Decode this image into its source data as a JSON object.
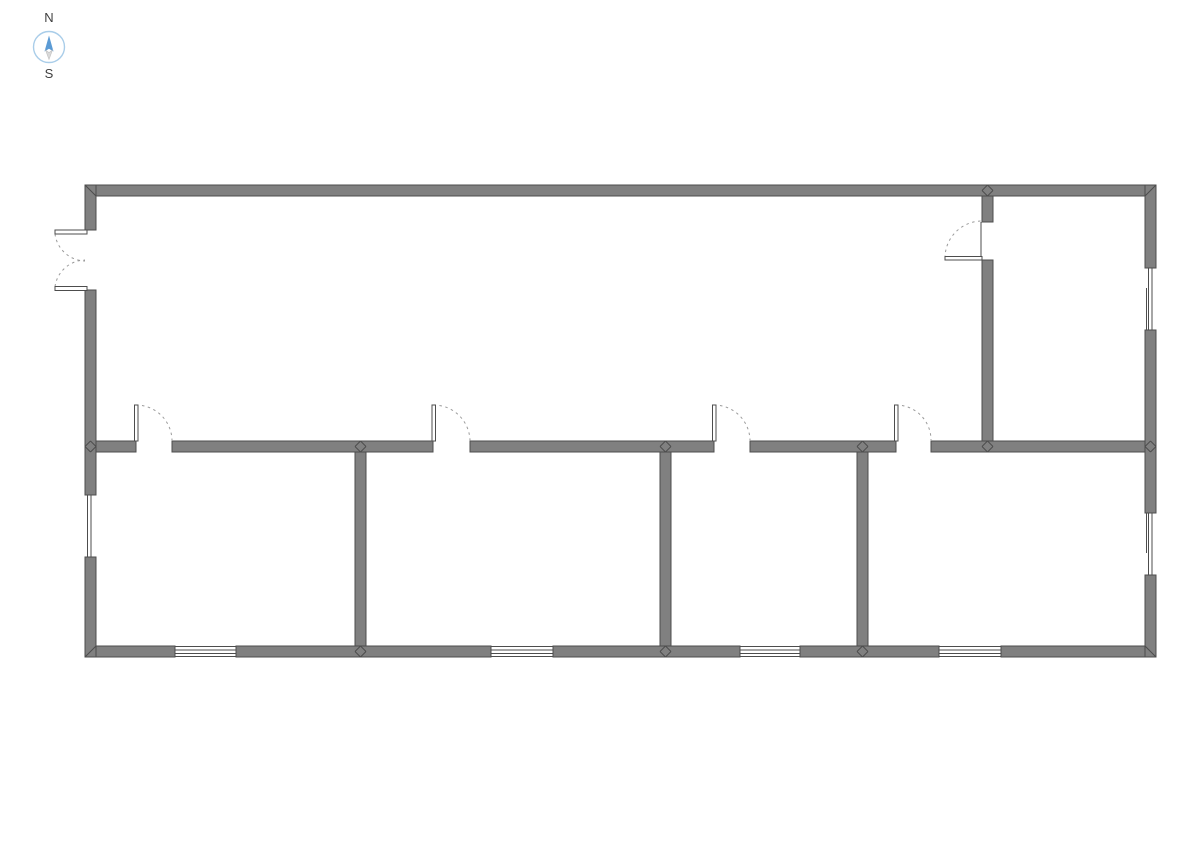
{
  "page": {
    "background": "#ffffff",
    "width": 1191,
    "height": 842
  },
  "compass": {
    "north_label": "N",
    "south_label": "S",
    "label_color": "#3f3f3f",
    "circle_color": "#a9cde9",
    "north_color": "#5b9bd5",
    "south_color": "#d9d9d9",
    "south_stroke": "#c0c0c0",
    "cx": 49,
    "cy": 47,
    "radius": 15.5
  },
  "floor_plan": {
    "wall_thickness": 11,
    "colors": {
      "wall_fill": "#808080",
      "wall_stroke": "#4d4d4d",
      "detail_line": "#4d4d4d",
      "door_arc": "#9a9a9a",
      "leaf_fill": "#ffffff"
    },
    "wall_segments": [
      {
        "name": "outer-wall-top",
        "x": 85,
        "y": 185,
        "w": 1071,
        "h": 11
      },
      {
        "name": "outer-wall-bottom-1",
        "x": 85,
        "y": 646,
        "w": 90,
        "h": 11
      },
      {
        "name": "outer-wall-bottom-2",
        "x": 236,
        "y": 646,
        "w": 255,
        "h": 11
      },
      {
        "name": "outer-wall-bottom-3",
        "x": 553,
        "y": 646,
        "w": 187,
        "h": 11
      },
      {
        "name": "outer-wall-bottom-4",
        "x": 800,
        "y": 646,
        "w": 139,
        "h": 11
      },
      {
        "name": "outer-wall-bottom-5",
        "x": 1001,
        "y": 646,
        "w": 155,
        "h": 11
      },
      {
        "name": "outer-wall-left-1",
        "x": 85,
        "y": 185,
        "w": 11,
        "h": 45
      },
      {
        "name": "outer-wall-left-2",
        "x": 85,
        "y": 290,
        "w": 11,
        "h": 205
      },
      {
        "name": "outer-wall-left-3",
        "x": 85,
        "y": 557,
        "w": 11,
        "h": 100
      },
      {
        "name": "outer-wall-right-1",
        "x": 1145,
        "y": 185,
        "w": 11,
        "h": 83
      },
      {
        "name": "outer-wall-right-2",
        "x": 1145,
        "y": 330,
        "w": 11,
        "h": 183
      },
      {
        "name": "outer-wall-right-3",
        "x": 1145,
        "y": 575,
        "w": 11,
        "h": 82
      },
      {
        "name": "interior-wall-horizontal-1",
        "x": 96,
        "y": 441,
        "w": 40,
        "h": 11
      },
      {
        "name": "interior-wall-horizontal-2",
        "x": 172,
        "y": 441,
        "w": 261,
        "h": 11
      },
      {
        "name": "interior-wall-horizontal-3",
        "x": 470,
        "y": 441,
        "w": 244,
        "h": 11
      },
      {
        "name": "interior-wall-horizontal-4",
        "x": 750,
        "y": 441,
        "w": 146,
        "h": 11
      },
      {
        "name": "interior-wall-horizontal-5",
        "x": 931,
        "y": 441,
        "w": 214,
        "h": 11
      },
      {
        "name": "interior-wall-vertical-topright-1",
        "x": 982,
        "y": 196,
        "w": 11,
        "h": 26
      },
      {
        "name": "interior-wall-vertical-topright-2",
        "x": 982,
        "y": 260,
        "w": 11,
        "h": 181
      },
      {
        "name": "interior-wall-vertical-room1",
        "x": 355,
        "y": 452,
        "w": 11,
        "h": 194
      },
      {
        "name": "interior-wall-vertical-room2",
        "x": 660,
        "y": 452,
        "w": 11,
        "h": 194
      },
      {
        "name": "interior-wall-vertical-room3",
        "x": 857,
        "y": 452,
        "w": 11,
        "h": 194
      }
    ],
    "corner_miters": [
      [
        85,
        185,
        96,
        196
      ],
      [
        1156,
        185,
        1145,
        196
      ],
      [
        85,
        657,
        96,
        646
      ],
      [
        1156,
        657,
        1145,
        646
      ]
    ],
    "t_junctions": [
      [
        987.5,
        190.5
      ],
      [
        987.5,
        446.5
      ],
      [
        90.5,
        446.5
      ],
      [
        1150.5,
        446.5
      ],
      [
        360.5,
        446.5
      ],
      [
        360.5,
        651.5
      ],
      [
        665.5,
        446.5
      ],
      [
        665.5,
        651.5
      ],
      [
        862.5,
        446.5
      ],
      [
        862.5,
        651.5
      ]
    ],
    "windows": [
      {
        "name": "window-bottom-1",
        "lines": [
          [
            175,
            646.5,
            236,
            646.5
          ],
          [
            175,
            650,
            236,
            650
          ],
          [
            175,
            653.5,
            236,
            653.5
          ],
          [
            175,
            656.5,
            236,
            656.5
          ]
        ]
      },
      {
        "name": "window-bottom-2",
        "lines": [
          [
            491,
            646.5,
            553,
            646.5
          ],
          [
            491,
            650,
            553,
            650
          ],
          [
            491,
            653.5,
            553,
            653.5
          ],
          [
            491,
            656.5,
            553,
            656.5
          ]
        ]
      },
      {
        "name": "window-bottom-3",
        "lines": [
          [
            740,
            646.5,
            800,
            646.5
          ],
          [
            740,
            650,
            800,
            650
          ],
          [
            740,
            653.5,
            800,
            653.5
          ],
          [
            740,
            656.5,
            800,
            656.5
          ]
        ]
      },
      {
        "name": "window-bottom-4",
        "lines": [
          [
            939,
            646.5,
            1001,
            646.5
          ],
          [
            939,
            650,
            1001,
            650
          ],
          [
            939,
            653.5,
            1001,
            653.5
          ],
          [
            939,
            656.5,
            1001,
            656.5
          ]
        ]
      },
      {
        "name": "window-left",
        "lines": [
          [
            87.5,
            495,
            87.5,
            557
          ],
          [
            91,
            495,
            91,
            557
          ]
        ]
      },
      {
        "name": "window-right-upper",
        "lines": [
          [
            1148.5,
            268,
            1148.5,
            330
          ],
          [
            1152,
            268,
            1152,
            330
          ],
          [
            1146.5,
            288,
            1146.5,
            330
          ]
        ]
      },
      {
        "name": "window-right-lower",
        "lines": [
          [
            1148.5,
            513,
            1148.5,
            575
          ],
          [
            1152,
            513,
            1152,
            575
          ],
          [
            1146.5,
            513,
            1146.5,
            553
          ]
        ]
      }
    ],
    "doors": [
      {
        "name": "interior-door-1",
        "leaves": [
          [
            134.5,
            405,
            3.5,
            36
          ]
        ],
        "arcs": [
          "M 136 405 A 36 36 0 0 1 172 441"
        ]
      },
      {
        "name": "interior-door-2",
        "leaves": [
          [
            432,
            405,
            3.5,
            36
          ]
        ],
        "arcs": [
          "M 433.5 405 A 36.5 36.5 0 0 1 470 441"
        ]
      },
      {
        "name": "interior-door-3",
        "leaves": [
          [
            712.5,
            405,
            3.5,
            36
          ]
        ],
        "arcs": [
          "M 714 405 A 36 36 0 0 1 750 441"
        ]
      },
      {
        "name": "interior-door-4",
        "leaves": [
          [
            894.5,
            405,
            3.5,
            36
          ]
        ],
        "arcs": [
          "M 896 405 A 35 35 0 0 1 931 441"
        ]
      },
      {
        "name": "top-right-room-door",
        "leaves": [
          [
            945,
            256.5,
            37,
            3.5
          ]
        ],
        "arcs": [
          "M 945 258 A 37 37 0 0 1 982 221"
        ],
        "frames": [
          [
            981,
            222,
            981,
            260
          ]
        ]
      },
      {
        "name": "entry-double-door",
        "leaves": [
          [
            55,
            230,
            32,
            4
          ],
          [
            55,
            286.5,
            32,
            4
          ]
        ],
        "arcs": [
          "M 55 234 A 31 31 0 0 0 85 261",
          "M 55 286.5 A 31 31 0 0 1 85 260"
        ]
      }
    ]
  }
}
